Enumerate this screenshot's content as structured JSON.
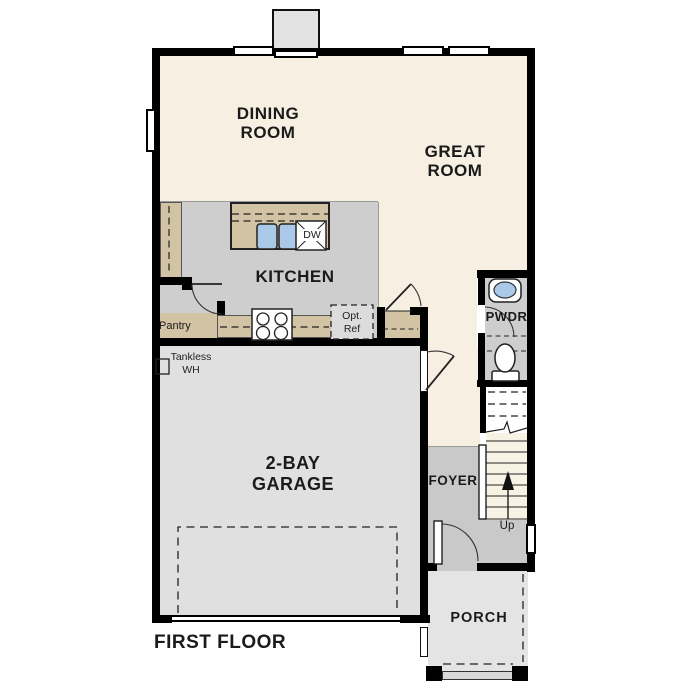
{
  "plan": {
    "title": "FIRST FLOOR"
  },
  "rooms": {
    "dining": {
      "line1": "DINING",
      "line2": "ROOM"
    },
    "great": {
      "line1": "GREAT",
      "line2": "ROOM"
    },
    "kitchen": {
      "label": "KITCHEN"
    },
    "pantry": {
      "label": "Pantry"
    },
    "garage": {
      "line1": "2-BAY",
      "line2": "GARAGE"
    },
    "foyer": {
      "label": "FOYER"
    },
    "powder": {
      "label": "PWDR"
    },
    "porch": {
      "label": "PORCH"
    },
    "stairs": {
      "up_label": "Up"
    }
  },
  "fixtures": {
    "dishwasher_label": "DW",
    "opt_ref_line1": "Opt.",
    "opt_ref_line2": "Ref",
    "water_heater_line1": "Tankless",
    "water_heater_line2": "WH"
  },
  "colors": {
    "cream": "#f7efe1",
    "kitchen_gray": "#cecece",
    "counter_tan": "#d2c3a4",
    "garage_gray": "#e0e0e0",
    "foyer_gray": "#c9c9c9",
    "porch_gray": "#e4e4e4",
    "stair_cream": "#f8f2e4",
    "sink_blue": "#aac9e8",
    "wall_black": "#000000"
  }
}
